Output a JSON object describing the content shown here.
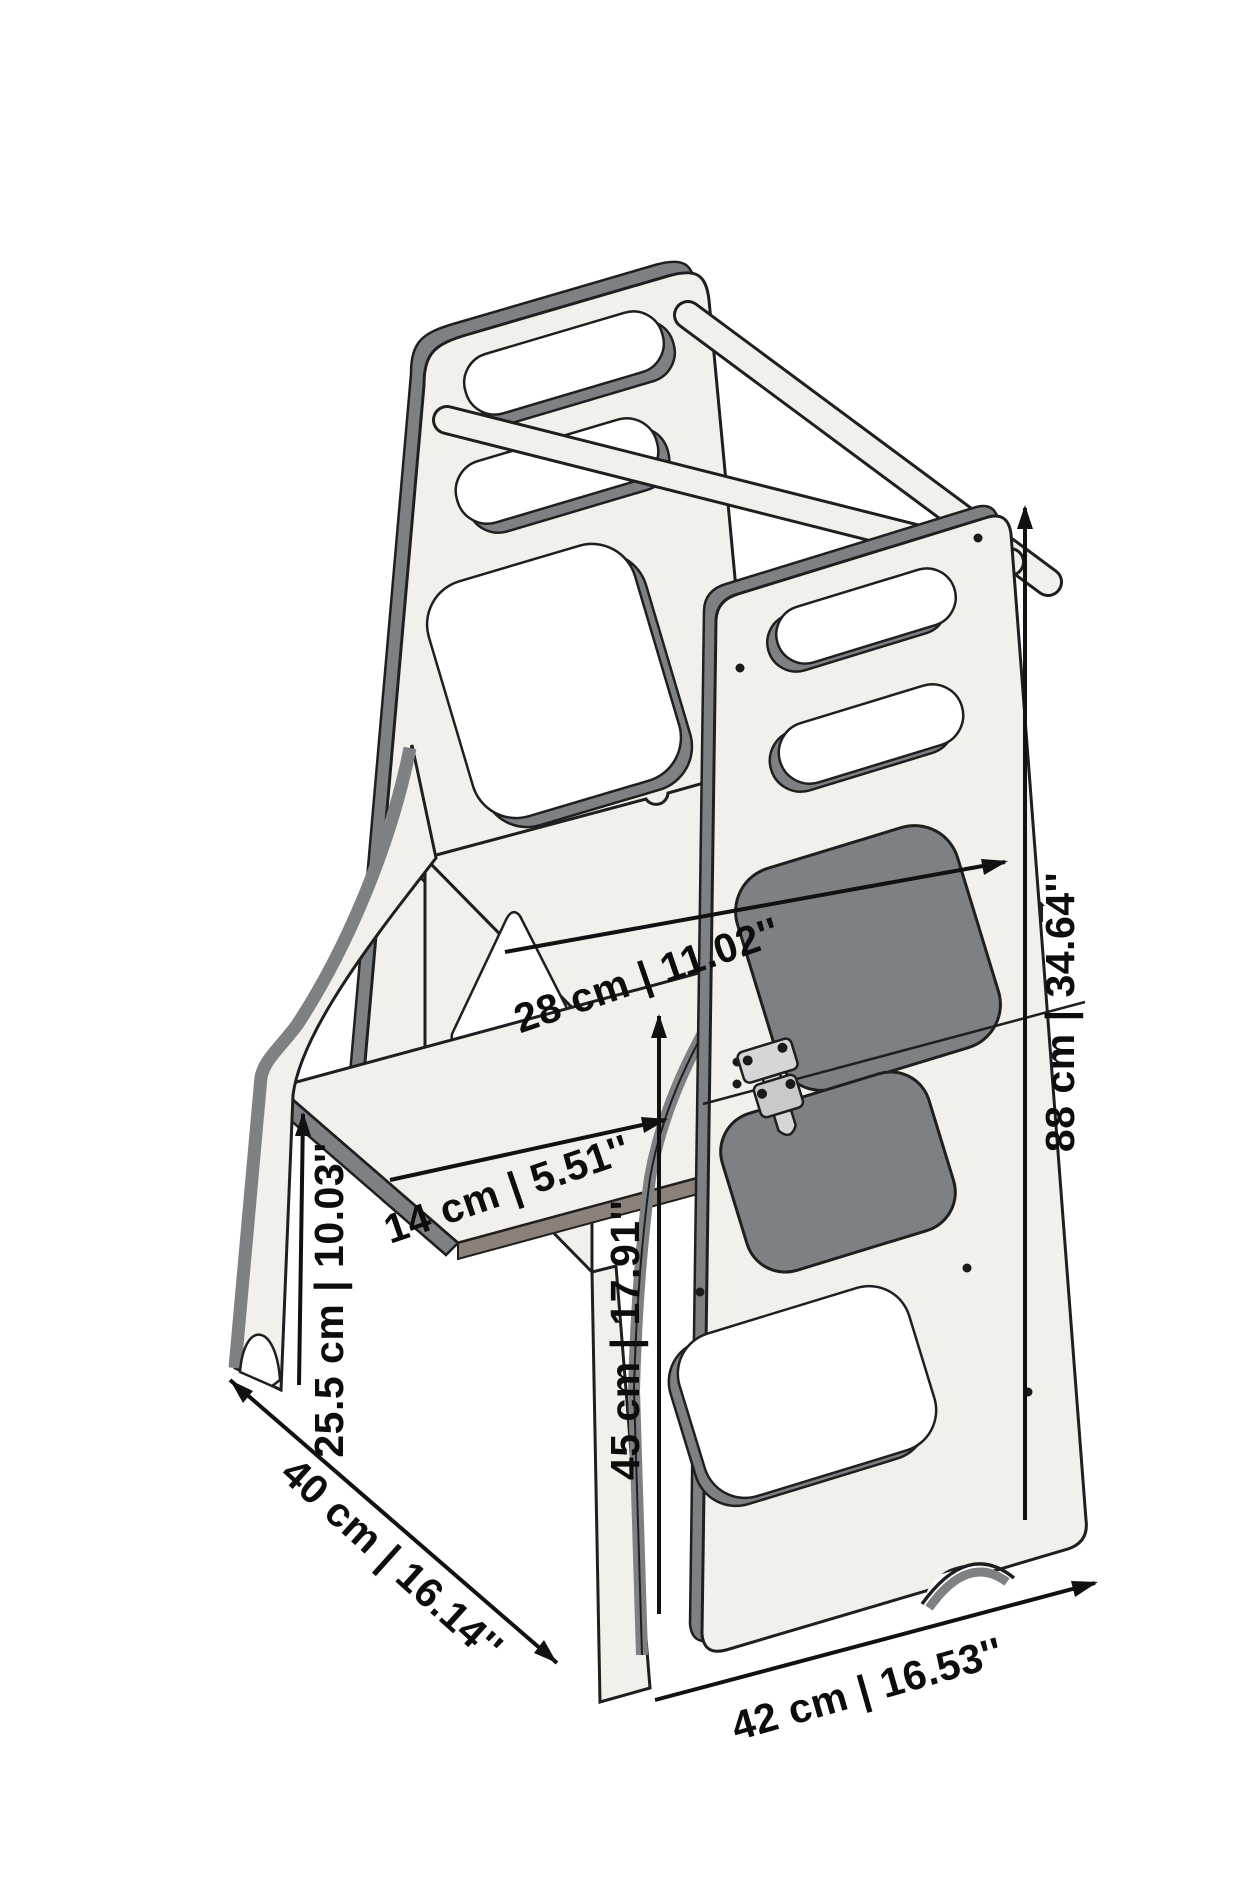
{
  "diagram": {
    "title": "Convertible learning tower / step stool dimensional drawing",
    "colors": {
      "background": "#ffffff",
      "panel_face": "#f2f0ea",
      "panel_edge_gray": "#7e8184",
      "panel_edge_warm": "#8b8178",
      "outline": "#1f1f1f",
      "dimension_text": "#0d0d0d",
      "hardware_metal": "#d6d6d6"
    },
    "labels": {
      "platform_depth": "28 cm | 11.02''",
      "step_depth": "14 cm | 5.51''",
      "step_height": "25.5 cm | 10.03''",
      "base_depth": "40 cm | 16.14''",
      "platform_height": "45 cm | 17.91''",
      "base_width": "42 cm | 16.53''",
      "total_height": "88 cm | 34.64''"
    }
  }
}
